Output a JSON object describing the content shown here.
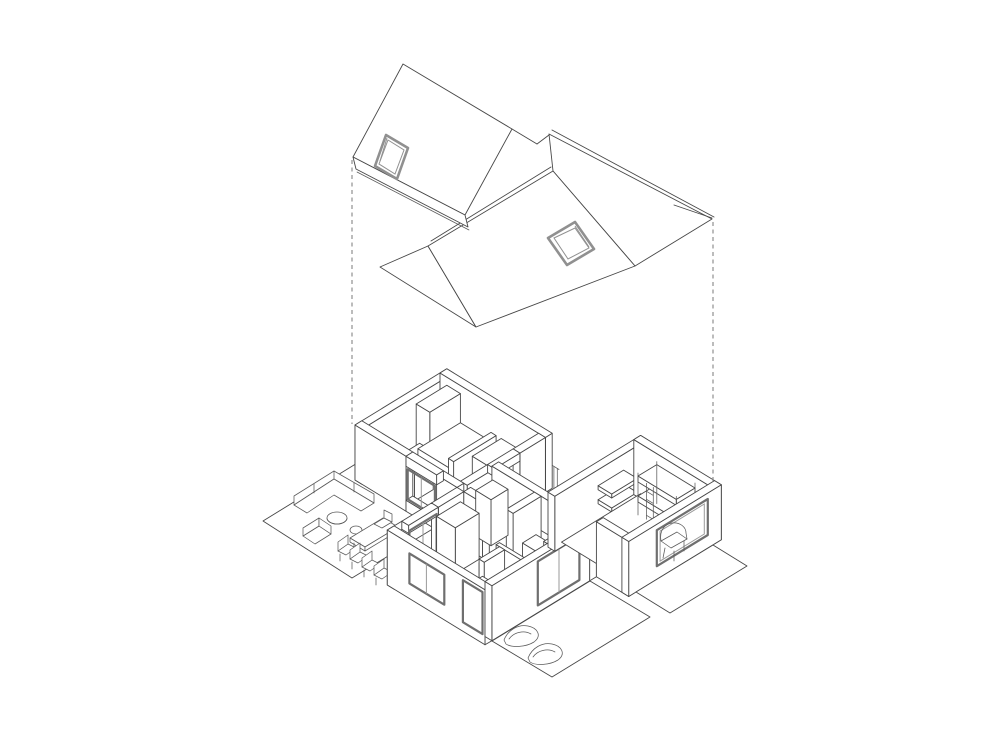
{
  "meta": {
    "title": "Exploded axonometric line drawing of a single-storey house with lifted roof",
    "drawing_type": "architectural axonometric diagram"
  },
  "drawing": {
    "background_color": "#ffffff",
    "line_color": "#474747",
    "furniture_line_color": "#5a5a5a",
    "glazing_frame_color": "#6f6f6f",
    "glass_line_color": "#9a9a9a",
    "skylight_frame_color": "#909090",
    "projection_line_color": "#858585",
    "projection_line_style": "dashed"
  },
  "scene": {
    "roof": {
      "label": "exploded roof assembly",
      "parts": [
        "left gable roof plane with skylight",
        "main gable roof plane with skylight",
        "east wing roof with ridge fascia",
        "west gable end triangle",
        "eave fascia"
      ]
    },
    "house": {
      "label": "open-top cutaway floor plan",
      "rooms": [
        "northwest bedroom",
        "rear storage room",
        "kitchen corridor",
        "living room with wood stove",
        "east bedroom with bunk bed"
      ]
    },
    "outdoor": {
      "west_terrace": [
        "corner sofa",
        "round coffee tables",
        "armchair",
        "dining table with chairs"
      ],
      "south_terrace": [
        "sun loungers"
      ],
      "east_platform": []
    },
    "projection": {
      "left_line": "roof-eave to wall-top guide",
      "right_line": "roof-ridge to wall-top guide"
    }
  }
}
